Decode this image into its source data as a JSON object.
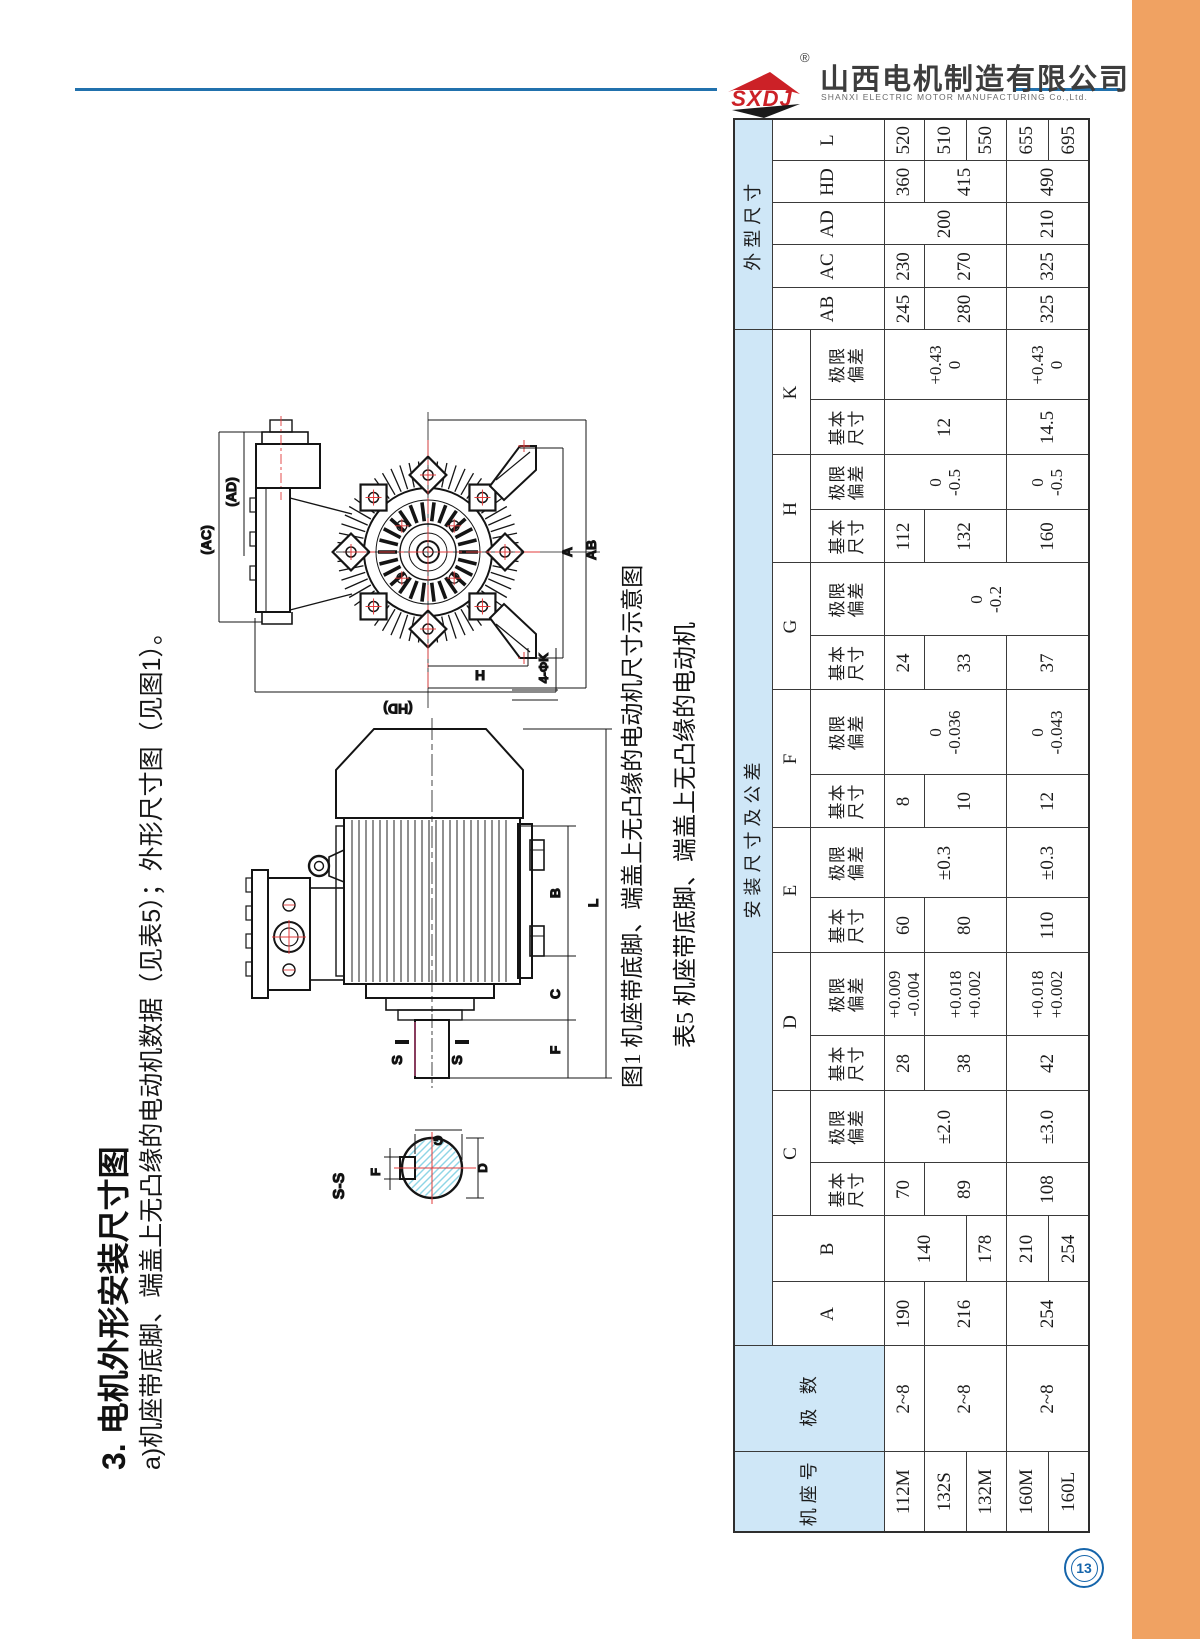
{
  "page": {
    "number": "13",
    "orange_color": "#F0A262",
    "accent_blue": "#2171AD"
  },
  "header": {
    "logo_text": "SXDJ",
    "reg_mark": "®",
    "company_cn": "山西电机制造有限公司",
    "company_en": "SHANXI ELECTRIC MOTOR MANUFACTURING Co.,Ltd."
  },
  "section": {
    "title": "3. 电机外形安装尺寸图",
    "subtitle": "a)机座带底脚、端盖上无凸缘的电动机数据（见表5）；外形尺寸图（见图1）。"
  },
  "figure": {
    "caption": "图1 机座带底脚、端盖上无凸缘的电动机尺寸示意图",
    "front": {
      "ad": "(AD)",
      "ac": "(AC)",
      "hd": "(HD)",
      "h": "H",
      "a": "A",
      "ab": "AB",
      "k4": "4-ΦK"
    },
    "side": {
      "b": "B",
      "c": "C",
      "f": "F",
      "l": "L",
      "s_left": "S",
      "s_right": "S"
    },
    "sec": {
      "title": "S-S",
      "g": "G",
      "d": "D",
      "f": "F"
    }
  },
  "table": {
    "caption": "表5 机座带底脚、端盖上无凸缘的电动机",
    "col_widths": [
      80,
      106,
      64,
      66,
      53,
      72,
      55,
      83,
      55,
      70,
      53,
      85,
      54,
      73,
      53,
      55,
      55,
      70,
      42,
      43,
      42,
      42,
      42
    ],
    "row_heights": [
      38,
      38,
      74,
      40,
      42,
      40,
      42,
      41
    ],
    "rows": [
      [
        {
          "t": "机座号",
          "r": 3,
          "cls": "hd"
        },
        {
          "t": "极 数",
          "r": 3,
          "cls": "hd"
        },
        {
          "t": "安装尺寸及公差",
          "c": 16,
          "cls": "hd"
        },
        {
          "t": "外型尺寸",
          "c": 5,
          "cls": "hd"
        }
      ],
      [
        {
          "t": "A",
          "r": 2
        },
        {
          "t": "B",
          "r": 2
        },
        {
          "t": "C",
          "c": 2
        },
        {
          "t": "D",
          "c": 2
        },
        {
          "t": "E",
          "c": 2
        },
        {
          "t": "F",
          "c": 2
        },
        {
          "t": "G",
          "c": 2
        },
        {
          "t": "H",
          "c": 2
        },
        {
          "t": "K",
          "c": 2
        },
        {
          "t": "AB",
          "r": 2
        },
        {
          "t": "AC",
          "r": 2
        },
        {
          "t": "AD",
          "r": 2
        },
        {
          "t": "HD",
          "r": 2
        },
        {
          "t": "L",
          "r": 2
        }
      ],
      [
        {
          "t": "基本\n尺寸",
          "cls": "sub"
        },
        {
          "t": "极限\n偏差",
          "cls": "sub"
        },
        {
          "t": "基本\n尺寸",
          "cls": "sub"
        },
        {
          "t": "极限\n偏差",
          "cls": "sub"
        },
        {
          "t": "基本\n尺寸",
          "cls": "sub"
        },
        {
          "t": "极限\n偏差",
          "cls": "sub"
        },
        {
          "t": "基本\n尺寸",
          "cls": "sub"
        },
        {
          "t": "极限\n偏差",
          "cls": "sub"
        },
        {
          "t": "基本\n尺寸",
          "cls": "sub"
        },
        {
          "t": "极限\n偏差",
          "cls": "sub"
        },
        {
          "t": "基本\n尺寸",
          "cls": "sub"
        },
        {
          "t": "极限\n偏差",
          "cls": "sub"
        },
        {
          "t": "基本\n尺寸",
          "cls": "sub"
        },
        {
          "t": "极限\n偏差",
          "cls": "sub"
        }
      ],
      [
        {
          "t": "112M"
        },
        {
          "t": "2~8"
        },
        {
          "t": "190"
        },
        {
          "t": "140",
          "r": 2
        },
        {
          "t": "70"
        },
        {
          "t": "±2.0",
          "r": 3
        },
        {
          "t": "28"
        },
        {
          "t": "+0.009\n-0.004"
        },
        {
          "t": "60"
        },
        {
          "t": "±0.3",
          "r": 3
        },
        {
          "t": "8"
        },
        {
          "t": "0\n-0.036",
          "r": 3
        },
        {
          "t": "24"
        },
        {
          "t": "0\n-0.2",
          "r": 5
        },
        {
          "t": "112"
        },
        {
          "t": "0\n-0.5",
          "r": 3
        },
        {
          "t": "12",
          "r": 3
        },
        {
          "t": "+0.43\n0",
          "r": 3
        },
        {
          "t": "245"
        },
        {
          "t": "230"
        },
        {
          "t": "200",
          "r": 3
        },
        {
          "t": "360"
        },
        {
          "t": "520"
        }
      ],
      [
        {
          "t": "132S"
        },
        {
          "t": "2~8",
          "r": 2
        },
        {
          "t": "216",
          "r": 2
        },
        {
          "t": "89",
          "r": 2
        },
        {
          "t": "38",
          "r": 2
        },
        {
          "t": "+0.018\n+0.002",
          "r": 2
        },
        {
          "t": "80",
          "r": 2
        },
        {
          "t": "10",
          "r": 2
        },
        {
          "t": "33",
          "r": 2
        },
        {
          "t": "132",
          "r": 2
        },
        {
          "t": "280",
          "r": 2
        },
        {
          "t": "270",
          "r": 2
        },
        {
          "t": "415",
          "r": 2
        },
        {
          "t": "510"
        }
      ],
      [
        {
          "t": "132M"
        },
        {
          "t": "178"
        },
        {
          "t": "550"
        }
      ],
      [
        {
          "t": "160M"
        },
        {
          "t": "2~8",
          "r": 2
        },
        {
          "t": "254",
          "r": 2
        },
        {
          "t": "210"
        },
        {
          "t": "108",
          "r": 2
        },
        {
          "t": "±3.0",
          "r": 2
        },
        {
          "t": "42",
          "r": 2
        },
        {
          "t": "+0.018\n+0.002",
          "r": 2
        },
        {
          "t": "110",
          "r": 2
        },
        {
          "t": "±0.3",
          "r": 2
        },
        {
          "t": "12",
          "r": 2
        },
        {
          "t": "0\n-0.043",
          "r": 2
        },
        {
          "t": "37",
          "r": 2
        },
        {
          "t": "160",
          "r": 2
        },
        {
          "t": "0\n-0.5",
          "r": 2
        },
        {
          "t": "14.5",
          "r": 2
        },
        {
          "t": "+0.43\n0",
          "r": 2
        },
        {
          "t": "325",
          "r": 2
        },
        {
          "t": "325",
          "r": 2
        },
        {
          "t": "210",
          "r": 2
        },
        {
          "t": "490",
          "r": 2
        },
        {
          "t": "655"
        }
      ],
      [
        {
          "t": "160L"
        },
        {
          "t": "254"
        },
        {
          "t": "695"
        }
      ]
    ]
  }
}
